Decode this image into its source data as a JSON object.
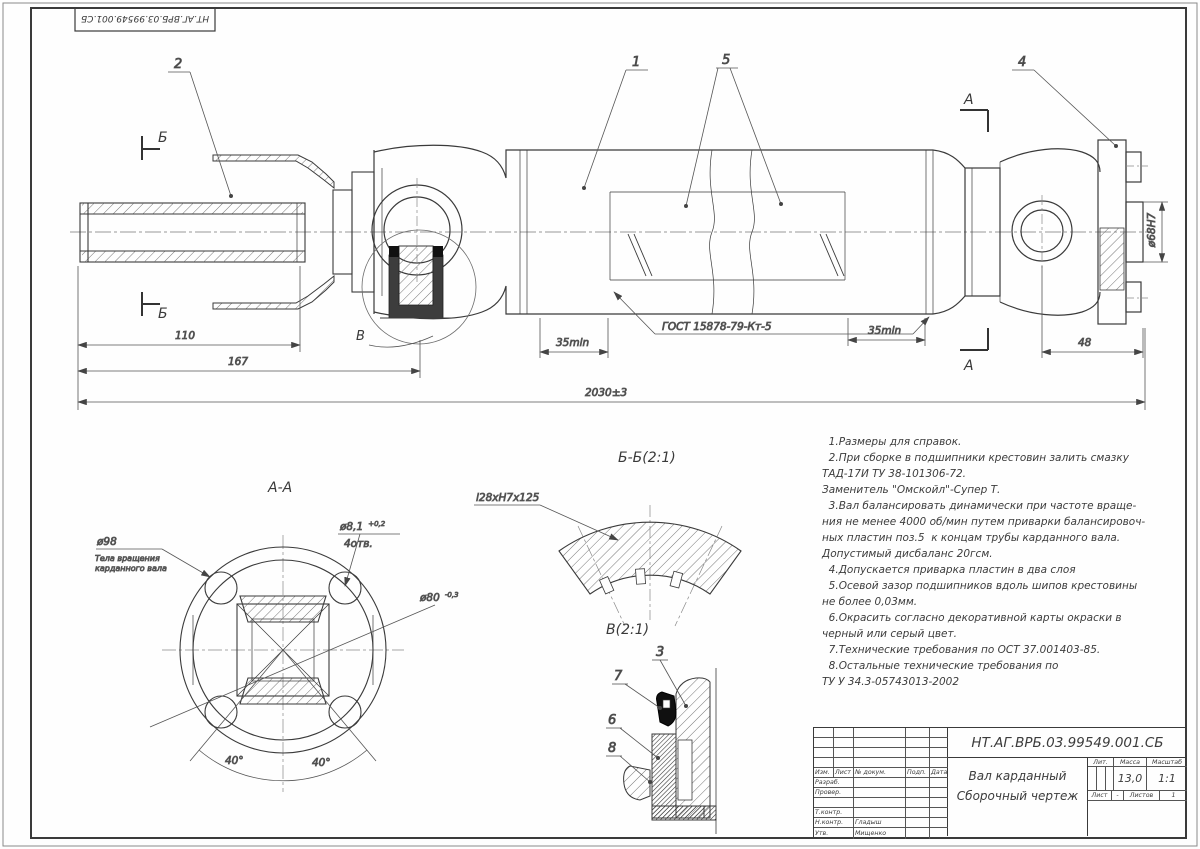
{
  "sheet": {
    "ink": "#3a3a3a",
    "bg": "#ffffff"
  },
  "corner_stamp": {
    "text": "НТ.АГ.ВРБ.03.99549.001.СБ"
  },
  "main_view": {
    "callout_1": "1",
    "callout_2": "2",
    "callout_4": "4",
    "callout_5": "5",
    "section_b": "Б",
    "section_a": "А",
    "detail_v_letter": "В",
    "dim_110": "110",
    "dim_167": "167",
    "dim_total": "2030±3",
    "dim_35_left": "35min",
    "dim_35_right": "35min",
    "dim_48": "48",
    "dim_flange": "ø68Н7",
    "weld_spec": "ГОСТ 15878-79-Кт-5"
  },
  "section_aa": {
    "title": "А-А",
    "dim_d98": "ø98",
    "note_line1": "Тела вращения",
    "note_line2": "карданного вала",
    "dim_d81": "ø8,1",
    "dim_d81_tol": "+0,2",
    "dim_d81_qty": "4отв.",
    "dim_d80": "ø80",
    "dim_d80_tol": "-0,3",
    "angle_left": "40°",
    "angle_right": "40°"
  },
  "section_bb": {
    "title": "Б-Б(2:1)",
    "spline_spec": "l28хН7х125"
  },
  "detail_v": {
    "title": "В(2:1)",
    "callout_3": "3",
    "callout_7": "7",
    "callout_6": "6",
    "callout_8": "8"
  },
  "tech_notes": {
    "lines": [
      "  1.Размеры для справок.",
      "  2.При сборке в подшипники крестовин залить смазку",
      "ТАД-17И ТУ 38-101306-72.",
      "Заменитель \"Омскойл\"-Супер Т.",
      "  3.Вал балансировать динамически при частоте враще-",
      "ния не менее 4000 об/мин путем приварки балансировоч-",
      "ных пластин поз.5  к концам трубы карданного вала.",
      "Допустимый дисбаланс 20гсм.",
      "  4.Допускается приварка пластин в два слоя",
      "  5.Осевой зазор подшипников вдоль шипов крестовины",
      "не более 0,03мм.",
      "  6.Окрасить согласно декоративной карты окраски в",
      "черный или серый цвет.",
      "  7.Технические требования по ОСТ 37.001403-85.",
      "  8.Остальные технические требования по",
      "ТУ У 34.3-05743013-2002"
    ]
  },
  "title_block": {
    "doc_number": "НТ.АГ.ВРБ.03.99549.001.СБ",
    "product_name": "Вал карданный",
    "doc_type": "Сборочный чертеж",
    "col_izm": "Изм.",
    "col_list": "Лист",
    "col_doc": "№ докум.",
    "col_sign": "Подп.",
    "col_date": "Дата",
    "row_razrab": "Разраб.",
    "row_prover": "Провер.",
    "row_tkontr": "Т.контр.",
    "row_nkontr": "Н.контр.",
    "row_utv": "Утв.",
    "name_nkontr": "Гладыш",
    "name_utv": "Мищенко",
    "lit_label": "Лит.",
    "mass_label": "Масса",
    "scale_label": "Масштаб",
    "mass_value": "13,0",
    "scale_value": "1:1",
    "sheet_label": "Лист",
    "sheet_value": "-",
    "sheets_label": "Листов",
    "sheets_value": "1"
  }
}
